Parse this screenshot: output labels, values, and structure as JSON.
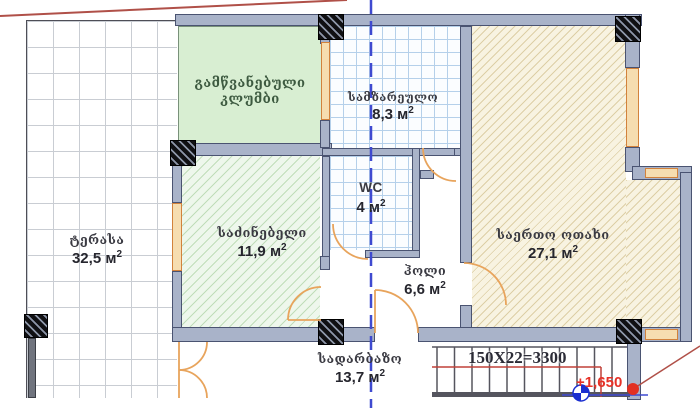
{
  "rooms": {
    "terrace": {
      "name": "ტერასა",
      "area": "32,5"
    },
    "flowerbed": {
      "name_line1": "გამწვანებული",
      "name_line2": "კლუმბი"
    },
    "kitchen": {
      "name": "სამზარეულო",
      "area": "8,3"
    },
    "wc": {
      "name": "WC",
      "area": "4"
    },
    "bedroom": {
      "name": "საძინებელი",
      "area": "11,9"
    },
    "hall": {
      "name": "ჰოლი",
      "area": "6,6"
    },
    "living_room": {
      "name": "საერთო ოთახი",
      "area": "27,1"
    },
    "entrance_lobby": {
      "name": "სადარბაზო",
      "area": "13,7"
    }
  },
  "units": {
    "symbol": "м",
    "sup": "2"
  },
  "stairs": {
    "dimension": "150X22=3300"
  },
  "elevation_mark": {
    "value": "+1,650"
  },
  "colors": {
    "wall_fill": "#a9b3c9",
    "wall_outline": "#4a5371",
    "window_frame": "#d2823c",
    "flowerbed_fill": "#d8eed2",
    "bedroom_hatch": "#c0ddb9",
    "living_hatch": "#ddcfa6",
    "kitchen_grid": "#b5d0ea",
    "section_line_blue": "#3f4ad0",
    "door_arc_orange": "#e8a45c",
    "elevation_red": "#e63228",
    "roof_line_red": "#b05048"
  }
}
